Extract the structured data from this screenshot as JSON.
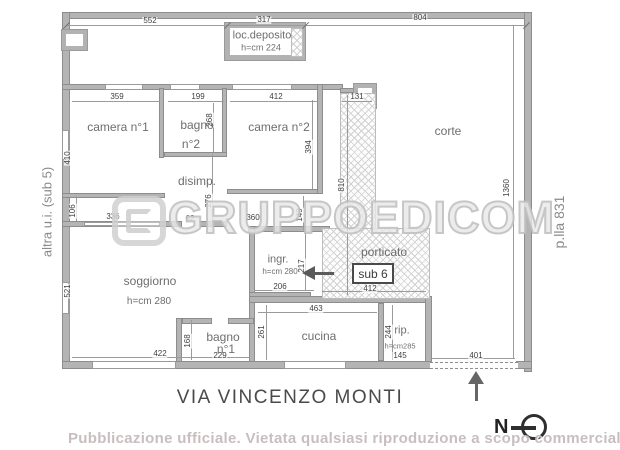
{
  "colors": {
    "wall": "#b4b4b4",
    "wall_edge": "#8d8d8d",
    "dim_text": "#3f3f3f",
    "label_text": "#6e6e6e",
    "banner_text": "#c5babc",
    "watermark_stroke": "#bebebe"
  },
  "side_labels": {
    "left": "altra u.i. (sub 5)",
    "right": "p.lla 831"
  },
  "street_label": "VIA VINCENZO MONTI",
  "compass": {
    "label": "N"
  },
  "watermark": {
    "logo": "GRUPPOEDICOM",
    "banner": "Pubblicazione ufficiale. Vietata qualsiasi riproduzione a scopo commerciale"
  },
  "rooms": {
    "deposito_name": "loc.deposito",
    "deposito_h": "h=cm 224",
    "camera1": "camera n°1",
    "bagno2_1": "bagno",
    "bagno2_2": "n°2",
    "camera2": "camera n°2",
    "disimp": "disimp.",
    "corte": "corte",
    "soggiorno": "soggiorno",
    "soggiorno_h": "h=cm 280",
    "ingresso": "ingr.",
    "ingresso_h": "h=cm 280",
    "porticato": "porticato",
    "sub6": "sub 6",
    "cucina": "cucina",
    "rip": "rip.",
    "rip_h": "h=cm285",
    "bagno1_1": "bagno",
    "bagno1_2": "n°1"
  },
  "dims": [
    "552",
    "317",
    "804",
    "359",
    "199",
    "412",
    "131",
    "410",
    "268",
    "394",
    "106",
    "336",
    "62",
    "360",
    "149",
    "276",
    "521",
    "217",
    "206",
    "422",
    "168",
    "229",
    "261",
    "463",
    "244",
    "145",
    "412",
    "401",
    "810",
    "1360"
  ]
}
